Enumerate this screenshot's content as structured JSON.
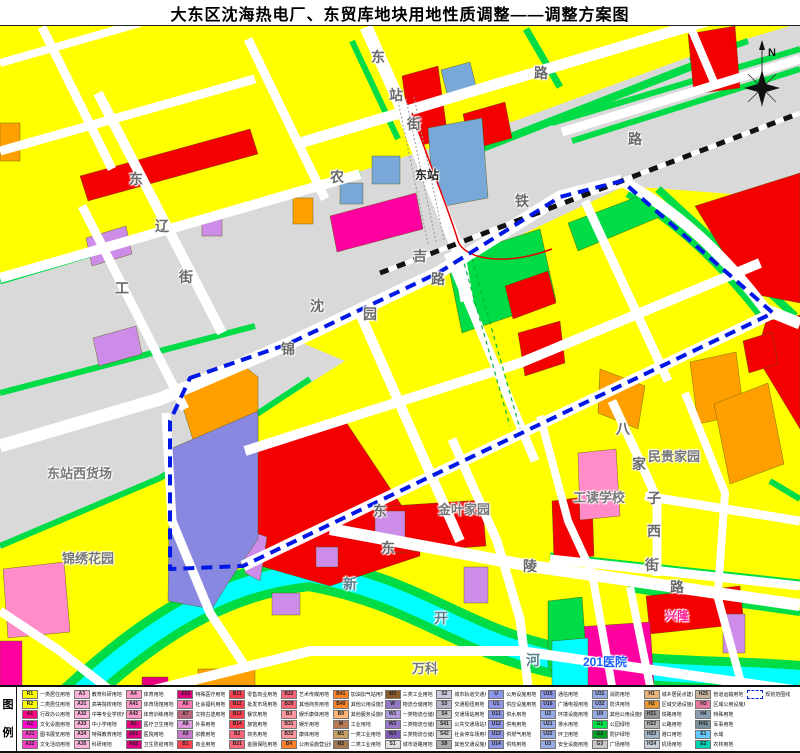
{
  "title": "大东区沈海热电厂、东贸库地块用地性质调整——调整方案图",
  "compass": {
    "label": "N"
  },
  "palette": {
    "parcel_yellow": "#FFFF00",
    "road_white": "#FFFFFF",
    "rail_gray": "#D9D9D9",
    "green": "#00DC46",
    "red": "#F40000",
    "orange": "#FFA000",
    "magenta": "#FF00A0",
    "pink": "#FF8CC8",
    "light_purple": "#CC8CE8",
    "blue_violet": "#8888E0",
    "steel_blue": "#78A8D8",
    "river_cyan": "#00FFFF",
    "boundary_blue": "#0018E6"
  },
  "map": {
    "labels": [
      {
        "t": "东",
        "x": 371,
        "y": 21
      },
      {
        "t": "站",
        "x": 389,
        "y": 59
      },
      {
        "t": "街",
        "x": 407,
        "y": 88
      },
      {
        "t": "路",
        "x": 534,
        "y": 37
      },
      {
        "t": "农",
        "x": 330,
        "y": 141
      },
      {
        "t": "东",
        "x": 129,
        "y": 143
      },
      {
        "t": "辽",
        "x": 155,
        "y": 190
      },
      {
        "t": "街",
        "x": 179,
        "y": 241
      },
      {
        "t": "工",
        "x": 115,
        "y": 252
      },
      {
        "t": "沈",
        "x": 310,
        "y": 270
      },
      {
        "t": "吉",
        "x": 413,
        "y": 220
      },
      {
        "t": "铁",
        "x": 515,
        "y": 165
      },
      {
        "t": "路",
        "x": 628,
        "y": 103
      },
      {
        "t": "锦",
        "x": 281,
        "y": 313
      },
      {
        "t": "园",
        "x": 363,
        "y": 278
      },
      {
        "t": "路",
        "x": 431,
        "y": 243
      },
      {
        "t": "东站",
        "x": 415,
        "y": 140,
        "c": "#222222",
        "s": 12
      },
      {
        "t": "八",
        "x": 616,
        "y": 393
      },
      {
        "t": "家",
        "x": 632,
        "y": 428
      },
      {
        "t": "子",
        "x": 647,
        "y": 462
      },
      {
        "t": "西",
        "x": 647,
        "y": 495
      },
      {
        "t": "街",
        "x": 645,
        "y": 529
      },
      {
        "t": "东",
        "x": 373,
        "y": 475
      },
      {
        "t": "东",
        "x": 381,
        "y": 512
      },
      {
        "t": "陵",
        "x": 523,
        "y": 530
      },
      {
        "t": "路",
        "x": 670,
        "y": 551
      },
      {
        "t": "新",
        "x": 343,
        "y": 548,
        "c": "#58808f"
      },
      {
        "t": "开",
        "x": 434,
        "y": 582,
        "c": "#58808f"
      },
      {
        "t": "河",
        "x": 526,
        "y": 624,
        "c": "#58808f"
      },
      {
        "t": "东站西货场",
        "x": 47,
        "y": 437,
        "s": 13,
        "c": "#777777"
      },
      {
        "t": "锦绣花园",
        "x": 62,
        "y": 522,
        "s": 13,
        "c": "#777777"
      },
      {
        "t": "金叶家园",
        "x": 438,
        "y": 473,
        "s": 13,
        "c": "#777777"
      },
      {
        "t": "工读学校",
        "x": 573,
        "y": 461,
        "s": 13,
        "c": "#777777"
      },
      {
        "t": "民贵家园",
        "x": 648,
        "y": 420,
        "s": 13,
        "c": "#777777"
      },
      {
        "t": "万科",
        "x": 412,
        "y": 632,
        "s": 13,
        "c": "#777777"
      },
      {
        "t": "201医院",
        "x": 583,
        "y": 627,
        "s": 12,
        "c": "#1560ff"
      },
      {
        "t": "兴隆",
        "x": 665,
        "y": 581,
        "s": 12,
        "c": "#ff2090"
      }
    ]
  },
  "legend": {
    "heading_chars": [
      "图",
      "例"
    ],
    "items": [
      {
        "code": "R1",
        "label": "一类居住用地",
        "color": "#FFFF00"
      },
      {
        "code": "R2",
        "label": "二类居住用地",
        "color": "#FFFF00"
      },
      {
        "code": "A1",
        "label": "行政办公用地",
        "color": "#FF0080"
      },
      {
        "code": "A2",
        "label": "文化设施用地",
        "color": "#FF00C8"
      },
      {
        "code": "A21",
        "label": "图书展览用地",
        "color": "#FF3CC8"
      },
      {
        "code": "A22",
        "label": "文化活动用地",
        "color": "#FF3CC8"
      },
      {
        "code": "A3",
        "label": "教育科研用地",
        "color": "#FFB4DC"
      },
      {
        "code": "A31",
        "label": "高等院校用地",
        "color": "#FFB4DC"
      },
      {
        "code": "A32",
        "label": "中等专业学校用地",
        "color": "#FFB4DC"
      },
      {
        "code": "A33",
        "label": "中小学用地",
        "color": "#FFB4DC"
      },
      {
        "code": "A34",
        "label": "特殊教育用地",
        "color": "#FFB4DC"
      },
      {
        "code": "A35",
        "label": "科研用地",
        "color": "#FFB4DC"
      },
      {
        "code": "A4",
        "label": "体育用地",
        "color": "#FF96C8"
      },
      {
        "code": "A41",
        "label": "体育场馆用地",
        "color": "#FF96C8"
      },
      {
        "code": "A42",
        "label": "体育训练用地",
        "color": "#FF96C8"
      },
      {
        "code": "A5",
        "label": "医疗卫生用地",
        "color": "#E1007D"
      },
      {
        "code": "A51",
        "label": "医院用地",
        "color": "#E1007D"
      },
      {
        "code": "A52",
        "label": "卫生防疫用地",
        "color": "#E1007D"
      },
      {
        "code": "A53",
        "label": "特殊医疗用地",
        "color": "#E1007D"
      },
      {
        "code": "A6",
        "label": "社会福利用地",
        "color": "#FF78B4"
      },
      {
        "code": "A7",
        "label": "文物古迹用地",
        "color": "#BE6478"
      },
      {
        "code": "A8",
        "label": "外事用地",
        "color": "#DC96DC"
      },
      {
        "code": "A9",
        "label": "宗教用地",
        "color": "#C878C8"
      },
      {
        "code": "B1",
        "label": "商业用地",
        "color": "#FF4150"
      },
      {
        "code": "B11",
        "label": "零售商业用地",
        "color": "#FF4150"
      },
      {
        "code": "B12",
        "label": "批发市场用地",
        "color": "#FF4150"
      },
      {
        "code": "B13",
        "label": "餐饮用地",
        "color": "#FF4150"
      },
      {
        "code": "B14",
        "label": "旅馆用地",
        "color": "#FF4150"
      },
      {
        "code": "B2",
        "label": "商务用地",
        "color": "#FF6478"
      },
      {
        "code": "B21",
        "label": "金融保险用地",
        "color": "#FF6478"
      },
      {
        "code": "B22",
        "label": "艺术传媒用地",
        "color": "#FF6478"
      },
      {
        "code": "B29",
        "label": "其他商务用地",
        "color": "#FF6478"
      },
      {
        "code": "B3",
        "label": "娱乐康体用地",
        "color": "#FF96A0"
      },
      {
        "code": "B31",
        "label": "娱乐用地",
        "color": "#FF96A0"
      },
      {
        "code": "B32",
        "label": "康体用地",
        "color": "#FF96A0"
      },
      {
        "code": "B4",
        "label": "公用设施营业网点用地",
        "color": "#FF8228"
      },
      {
        "code": "B41",
        "label": "加油加气站用地",
        "color": "#FF8228"
      },
      {
        "code": "B49",
        "label": "其他公用设施营业网点用地",
        "color": "#FF8228"
      },
      {
        "code": "B9",
        "label": "其他服务设施用地",
        "color": "#FFB478"
      },
      {
        "code": "M",
        "label": "工业用地",
        "color": "#B97A57"
      },
      {
        "code": "M1",
        "label": "一类工业用地",
        "color": "#C8A064"
      },
      {
        "code": "M2",
        "label": "二类工业用地",
        "color": "#A57850"
      },
      {
        "code": "M3",
        "label": "三类工业用地",
        "color": "#8B5A2B"
      },
      {
        "code": "W",
        "label": "物流仓储用地",
        "color": "#9678C8"
      },
      {
        "code": "W1",
        "label": "一类物流仓储用地",
        "color": "#B49BE0"
      },
      {
        "code": "W2",
        "label": "二类物流仓储用地",
        "color": "#9678C8"
      },
      {
        "code": "W3",
        "label": "三类物流仓储用地",
        "color": "#7D5AB4"
      },
      {
        "code": "S1",
        "label": "城市道路用地",
        "color": "#E0E0E0"
      },
      {
        "code": "S2",
        "label": "城市轨道交通用地",
        "color": "#C8C8DC"
      },
      {
        "code": "S3",
        "label": "交通枢纽用地",
        "color": "#B4B4C8"
      },
      {
        "code": "S4",
        "label": "交通场站用地",
        "color": "#BEBEBE"
      },
      {
        "code": "S41",
        "label": "公共交通场站用地",
        "color": "#BEBEBE"
      },
      {
        "code": "S42",
        "label": "社会停车场用地",
        "color": "#D2D2D2"
      },
      {
        "code": "S9",
        "label": "其他交通设施用地",
        "color": "#AAAAAA"
      },
      {
        "code": "U",
        "label": "公用设施用地",
        "color": "#8C96E6"
      },
      {
        "code": "U1",
        "label": "供应设施用地",
        "color": "#8C96E6"
      },
      {
        "code": "U11",
        "label": "供水用地",
        "color": "#8C96E6"
      },
      {
        "code": "U12",
        "label": "供电用地",
        "color": "#8C96E6"
      },
      {
        "code": "U13",
        "label": "供燃气用地",
        "color": "#8C96E6"
      },
      {
        "code": "U14",
        "label": "供热用地",
        "color": "#8C96E6"
      },
      {
        "code": "U15",
        "label": "通信用地",
        "color": "#8C96E6"
      },
      {
        "code": "U16",
        "label": "广播电视用地",
        "color": "#8C96E6"
      },
      {
        "code": "U2",
        "label": "环境设施用地",
        "color": "#96AAE6"
      },
      {
        "code": "U21",
        "label": "排水用地",
        "color": "#96AAE6"
      },
      {
        "code": "U22",
        "label": "环卫用地",
        "color": "#96AAE6"
      },
      {
        "code": "U3",
        "label": "安全设施用地",
        "color": "#96AAE6"
      },
      {
        "code": "U31",
        "label": "消防用地",
        "color": "#96AAE6"
      },
      {
        "code": "U32",
        "label": "防洪用地",
        "color": "#96AAE6"
      },
      {
        "code": "U9",
        "label": "其他公用设施用地",
        "color": "#96AAE6"
      },
      {
        "code": "G1",
        "label": "公园绿地",
        "color": "#00E046"
      },
      {
        "code": "G2",
        "label": "防护绿地",
        "color": "#00A028"
      },
      {
        "code": "G3",
        "label": "广场用地",
        "color": "#C8C8C8"
      },
      {
        "code": "H1",
        "label": "城乡居民点建设用地",
        "color": "#E6B478"
      },
      {
        "code": "H2",
        "label": "区域交通设施用地",
        "color": "#E69632"
      },
      {
        "code": "H21",
        "label": "铁路用地",
        "color": "#969696"
      },
      {
        "code": "H22",
        "label": "公路用地",
        "color": "#B4B4B4"
      },
      {
        "code": "H23",
        "label": "港口用地",
        "color": "#A0B4C8"
      },
      {
        "code": "H24",
        "label": "机场用地",
        "color": "#C8D2DC"
      },
      {
        "code": "H25",
        "label": "管道运输用地",
        "color": "#C8B49B"
      },
      {
        "code": "H3",
        "label": "区域公用设施用地",
        "color": "#E678A0"
      },
      {
        "code": "H4",
        "label": "特殊用地",
        "color": "#8CA0B4"
      },
      {
        "code": "H41",
        "label": "军事用地",
        "color": "#78909C"
      },
      {
        "code": "E1",
        "label": "水域",
        "color": "#64C8FF"
      },
      {
        "code": "E2",
        "label": "农林用地",
        "color": "#00D2B4"
      },
      {
        "code": "",
        "label": "规划范围线",
        "color": "boundary"
      }
    ]
  }
}
